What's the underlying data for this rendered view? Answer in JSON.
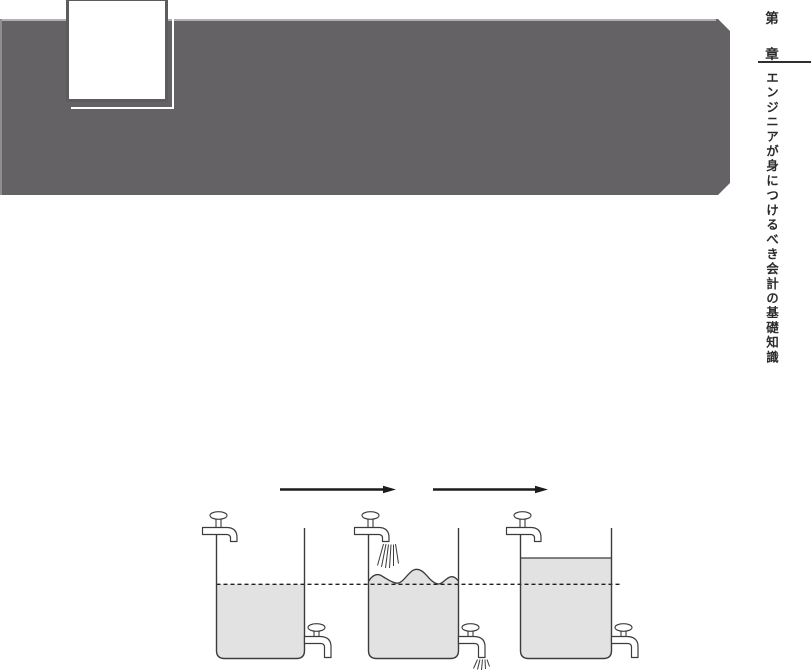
{
  "sidebar": {
    "chapter_prefix": "第",
    "chapter_suffix": "章",
    "title": "エンジニアが身につけるべき会計の基礎知識",
    "text_color": "#2b2b2b",
    "divider_color": "#2f2f2f"
  },
  "banner": {
    "color": "#646264",
    "highlight_color": "#b2b0b2",
    "chapter_box_fill": "#ffffff",
    "chapter_box_border": "#5c5b5e",
    "shadow_outline_color": "#ffffff"
  },
  "diagram": {
    "type": "three-tank-water-flow",
    "colors": {
      "water": "#e2e2e2",
      "outline": "#3c3c3c",
      "ink": "#1c1c1c"
    },
    "arrow_count": 2,
    "tanks": [
      {
        "id": "left",
        "surface": "flat",
        "level": "at-dashed-line",
        "top_faucet_running": false,
        "bottom_faucet_running": false
      },
      {
        "id": "middle",
        "surface": "wavy",
        "level": "at-dashed-line",
        "top_faucet_running": true,
        "bottom_faucet_running": true
      },
      {
        "id": "right",
        "surface": "flat",
        "level": "above-dashed-line",
        "top_faucet_running": false,
        "bottom_faucet_running": false
      }
    ]
  }
}
